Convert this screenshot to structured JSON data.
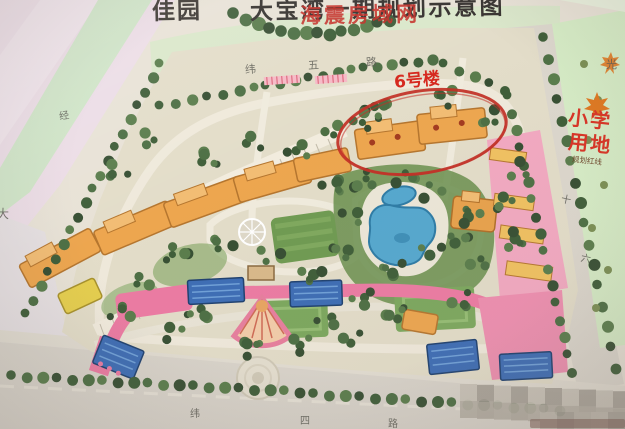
{
  "title": {
    "prefix": "佳园",
    "main": "大宝湾一期规划示意图"
  },
  "watermarks": {
    "overlay": "海震房域网"
  },
  "labels": {
    "building6": "6号楼",
    "school_line1": "小学",
    "school_line2": "用地",
    "school_note": "规划红线"
  },
  "roads": {
    "top": [
      "纬",
      "五",
      "路"
    ],
    "bottom": [
      "纬",
      "四",
      "路"
    ],
    "right": [
      "十",
      "六"
    ],
    "left_inner": "经",
    "left_edge": "大",
    "corner_right": "光"
  },
  "colors": {
    "annotation_red": "#d6281e",
    "school_red": "#d93425",
    "pool_blue": "#55a8cf",
    "commercial_pink": "#ec7ba3",
    "roof_orange": "#e8a24c",
    "shop_blue": "#3d6db5"
  }
}
